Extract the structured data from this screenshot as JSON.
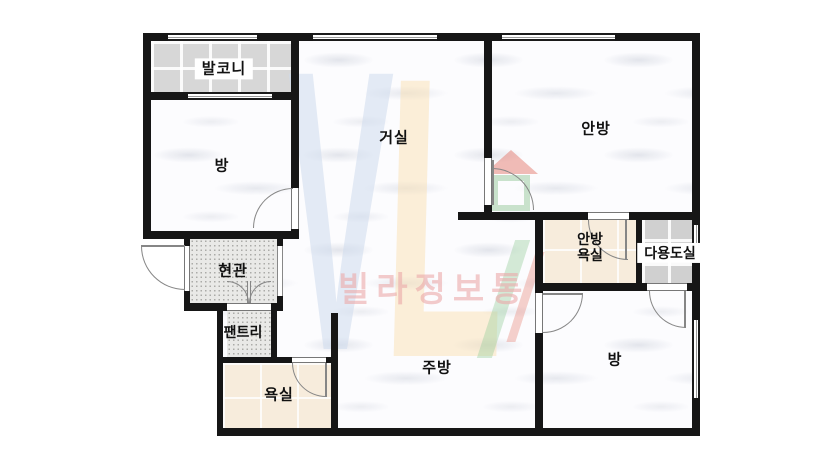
{
  "plan": {
    "rooms": {
      "balcony": {
        "label": "발코니"
      },
      "room_top_left": {
        "label": "방"
      },
      "living_room": {
        "label": "거실"
      },
      "master_bedroom": {
        "label": "안방"
      },
      "entrance": {
        "label": "현관"
      },
      "pantry": {
        "label": "팬트리"
      },
      "bathroom": {
        "label": "욕실"
      },
      "kitchen": {
        "label": "주방"
      },
      "master_bathroom": {
        "label_line1": "안방",
        "label_line2": "욕실"
      },
      "utility_room": {
        "label": "다용도실"
      },
      "room_bottom_right": {
        "label": "방"
      }
    },
    "colors": {
      "wall": "#161616",
      "balcony_tile": "#d7d7d7",
      "utility_tile": "#d0d0d0",
      "bath_tile": "#f7ecdc",
      "entry_floor": "#e9e9e7",
      "marble_floor": "#fcfcfe"
    }
  },
  "watermark": {
    "letter_v": "V",
    "letter_l": "L",
    "brand_text": "빌라정보통",
    "colors": {
      "v_blue": "#cddaed",
      "l_yellow": "#fae0b2",
      "brand_pink": "#eba8a8",
      "roof_red": "#e47a6e",
      "house_green": "#8cc391"
    }
  }
}
